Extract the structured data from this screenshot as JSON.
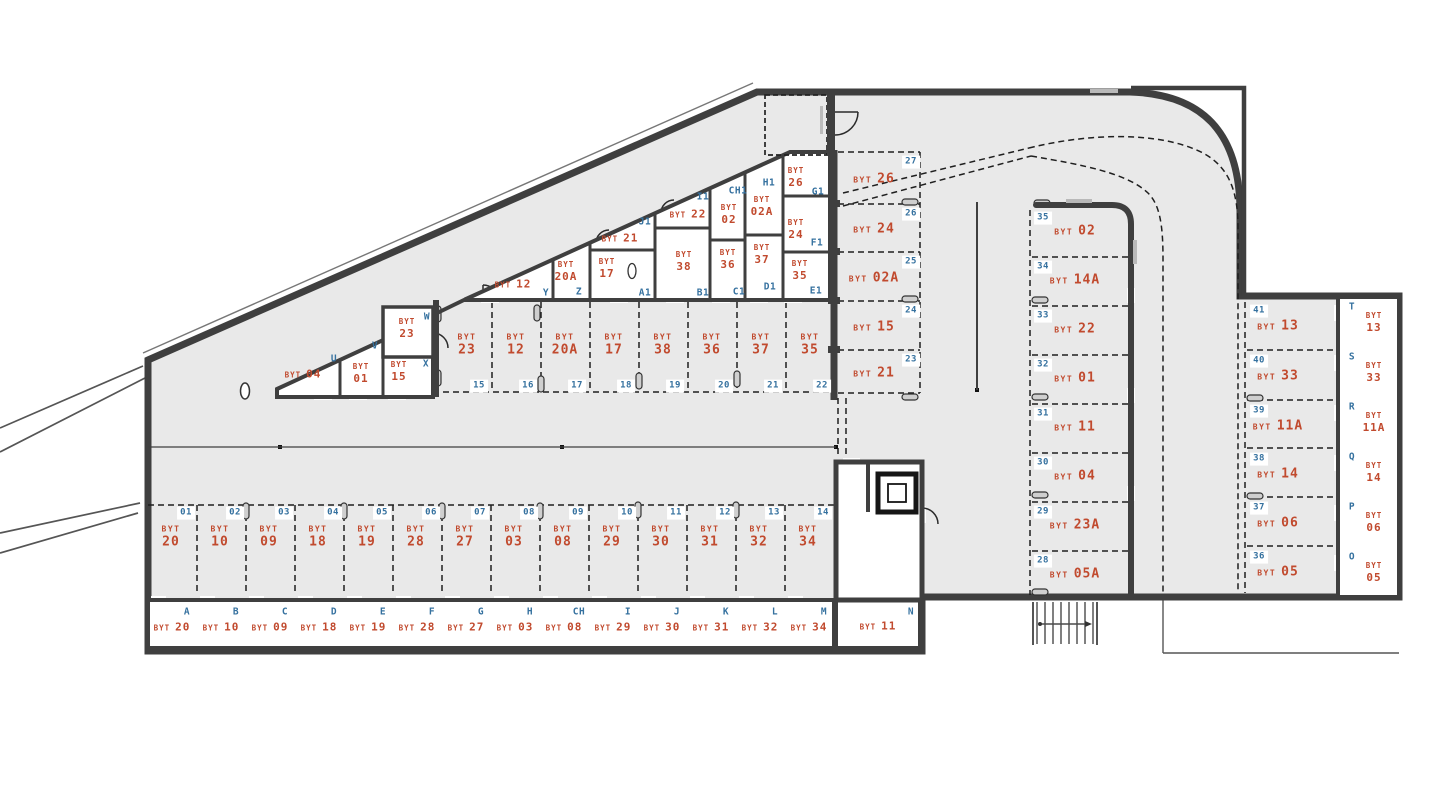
{
  "meta": {
    "unit_prefix": "BYT",
    "drawing_type": "garage-floor-plan"
  },
  "colors": {
    "background": "#ffffff",
    "floor": "#e9e9e9",
    "wall": "#3f3f3f",
    "unit_label": "#c14a2e",
    "reference": "#35719f",
    "dash": "#1f1f1f"
  },
  "parking": {
    "middle_row": [
      {
        "spot": "15",
        "unit": "23"
      },
      {
        "spot": "16",
        "unit": "12"
      },
      {
        "spot": "17",
        "unit": "20A"
      },
      {
        "spot": "18",
        "unit": "17"
      },
      {
        "spot": "19",
        "unit": "38"
      },
      {
        "spot": "20",
        "unit": "36"
      },
      {
        "spot": "21",
        "unit": "37"
      },
      {
        "spot": "22",
        "unit": "35"
      }
    ],
    "bottom_row": [
      {
        "spot": "01",
        "unit": "20"
      },
      {
        "spot": "02",
        "unit": "10"
      },
      {
        "spot": "03",
        "unit": "09"
      },
      {
        "spot": "04",
        "unit": "18"
      },
      {
        "spot": "05",
        "unit": "19"
      },
      {
        "spot": "06",
        "unit": "28"
      },
      {
        "spot": "07",
        "unit": "27"
      },
      {
        "spot": "08",
        "unit": "03"
      },
      {
        "spot": "09",
        "unit": "08"
      },
      {
        "spot": "10",
        "unit": "29"
      },
      {
        "spot": "11",
        "unit": "30"
      },
      {
        "spot": "12",
        "unit": "31"
      },
      {
        "spot": "13",
        "unit": "32"
      },
      {
        "spot": "14",
        "unit": "34"
      }
    ],
    "left_column": [
      {
        "spot": "27",
        "unit": "26"
      },
      {
        "spot": "26",
        "unit": "24"
      },
      {
        "spot": "25",
        "unit": "02A"
      },
      {
        "spot": "24",
        "unit": "15"
      },
      {
        "spot": "23",
        "unit": "21"
      }
    ],
    "right_column": [
      {
        "spot": "35",
        "unit": "02"
      },
      {
        "spot": "34",
        "unit": "14A"
      },
      {
        "spot": "33",
        "unit": "22"
      },
      {
        "spot": "32",
        "unit": "01"
      },
      {
        "spot": "31",
        "unit": "11"
      },
      {
        "spot": "30",
        "unit": "04"
      },
      {
        "spot": "29",
        "unit": "23A"
      },
      {
        "spot": "28",
        "unit": "05A"
      }
    ],
    "far_right_column": [
      {
        "spot": "41",
        "unit": "13"
      },
      {
        "spot": "40",
        "unit": "33"
      },
      {
        "spot": "39",
        "unit": "11A"
      },
      {
        "spot": "38",
        "unit": "14"
      },
      {
        "spot": "37",
        "unit": "06"
      },
      {
        "spot": "36",
        "unit": "05"
      }
    ]
  },
  "storage_cells": {
    "bottom_row": [
      {
        "ref": "A",
        "unit": "20"
      },
      {
        "ref": "B",
        "unit": "10"
      },
      {
        "ref": "C",
        "unit": "09"
      },
      {
        "ref": "D",
        "unit": "18"
      },
      {
        "ref": "E",
        "unit": "19"
      },
      {
        "ref": "F",
        "unit": "28"
      },
      {
        "ref": "G",
        "unit": "27"
      },
      {
        "ref": "H",
        "unit": "03"
      },
      {
        "ref": "CH",
        "unit": "08"
      },
      {
        "ref": "I",
        "unit": "29"
      },
      {
        "ref": "J",
        "unit": "30"
      },
      {
        "ref": "K",
        "unit": "31"
      },
      {
        "ref": "L",
        "unit": "32"
      },
      {
        "ref": "M",
        "unit": "34"
      }
    ],
    "core_cell": {
      "ref": "N",
      "unit": "11"
    },
    "right_column": [
      {
        "ref": "T",
        "unit": "13"
      },
      {
        "ref": "S",
        "unit": "33"
      },
      {
        "ref": "R",
        "unit": "11A"
      },
      {
        "ref": "Q",
        "unit": "14"
      },
      {
        "ref": "P",
        "unit": "06"
      },
      {
        "ref": "O",
        "unit": "05"
      }
    ],
    "diagonal_block": [
      {
        "ref": "U",
        "unit": "04"
      },
      {
        "ref": "V",
        "unit": "01"
      },
      {
        "ref": "X",
        "unit": "15"
      },
      {
        "ref": "W",
        "unit": "23"
      },
      {
        "ref": "Y",
        "unit": "12"
      },
      {
        "ref": "Z",
        "unit": "20A"
      },
      {
        "ref": "A1",
        "unit": "17"
      },
      {
        "ref": "B1",
        "unit": "38"
      },
      {
        "ref": "C1",
        "unit": "36"
      },
      {
        "ref": "D1",
        "unit": "37"
      },
      {
        "ref": "E1",
        "unit": "35"
      },
      {
        "ref": "J1",
        "unit": "21"
      },
      {
        "ref": "I1",
        "unit": "22"
      },
      {
        "ref": "CH1",
        "unit": "02"
      },
      {
        "ref": "H1",
        "unit": "02A"
      },
      {
        "ref": "G1",
        "unit": "26"
      },
      {
        "ref": "F1",
        "unit": "24"
      }
    ]
  }
}
